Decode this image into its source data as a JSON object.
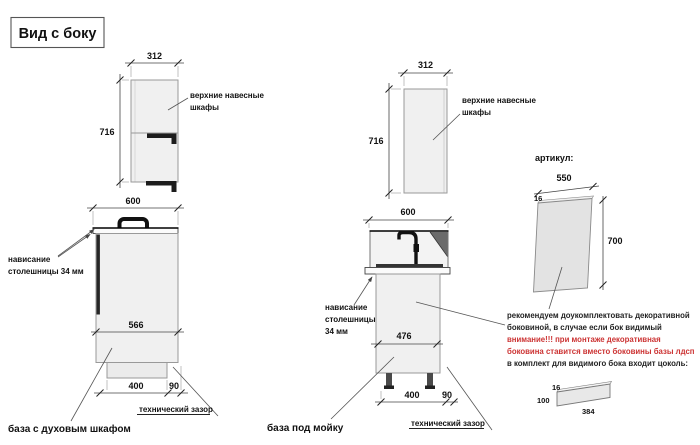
{
  "title": "Вид с боку",
  "colors": {
    "warning_red": "#cc3333",
    "cabinet_fill": "#f0f0f0",
    "dark_parts": "#1c1c1c",
    "line": "#444444"
  },
  "oven_unit": {
    "name": "база с духовым шкафом",
    "upper_label": [
      "верхние навесные",
      "шкафы"
    ],
    "overhang": [
      "нависание",
      "столешницы 34 мм"
    ],
    "tech_gap": "технический зазор",
    "dims": {
      "upper_width": "312",
      "upper_height": "716",
      "depth": "600",
      "body_depth": "566",
      "plinth": "400",
      "gap": "90"
    }
  },
  "sink_unit": {
    "name": "база под мойку",
    "upper_label": [
      "верхние навесные",
      "шкафы"
    ],
    "overhang": [
      "нависание",
      "столешницы",
      "34 мм"
    ],
    "tech_gap": "технический зазор",
    "dims": {
      "upper_width": "312",
      "upper_height": "716",
      "depth": "600",
      "body_depth": "476",
      "plinth": "400",
      "gap": "90"
    }
  },
  "side_panel": {
    "heading": "артикул:",
    "dims": {
      "width": "550",
      "thickness": "16",
      "height": "700"
    },
    "note": [
      "рекомендуем доукомплектовать декоративной",
      "боковиной, в случае если бок видимый",
      "внимание!!! при монтаже декоративная",
      "боковина ставится вместо боковины базы лдсп",
      "в комплект для видимого бока входит цоколь:"
    ]
  },
  "plinth": {
    "dims": {
      "thickness": "16",
      "height": "100",
      "length": "384"
    }
  }
}
